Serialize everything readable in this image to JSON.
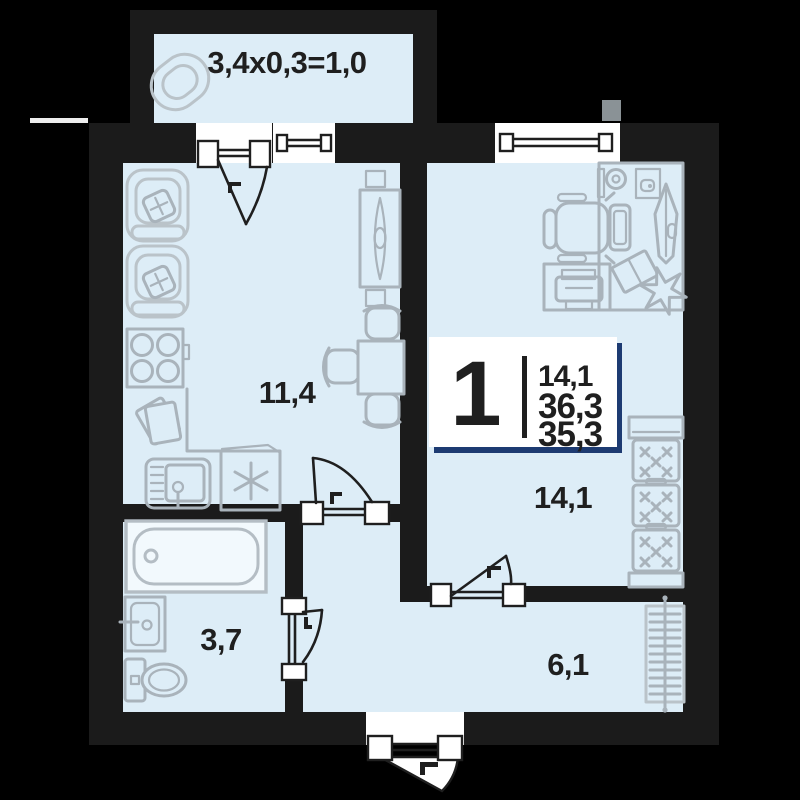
{
  "plan": {
    "balcony_label": "3,4x0,3=1,0",
    "rooms": {
      "kitchen_living": "11,4",
      "bedroom": "14,1",
      "bathroom": "3,7",
      "hallway": "6,1"
    },
    "badge": {
      "rooms_count": "1",
      "values": [
        "14,1",
        "36,3",
        "35,3"
      ]
    },
    "colors": {
      "background": "#000000",
      "wall": "#1b1b1b",
      "room_fill": "#ddedf7",
      "furniture": "#a9b3bb",
      "accent_navy": "#1d3b72",
      "text": "#1f1f1f",
      "white": "#ffffff"
    },
    "icons": [
      "papasan-chair-icon",
      "armchair-icon",
      "stove-icon",
      "papers-icon",
      "kitchen-sink-icon",
      "fridge-freezer-icon",
      "tv-stand-icon",
      "dining-table-icon",
      "chair-icon",
      "office-chair-icon",
      "desk-icon",
      "monitor-icon",
      "cup-icon",
      "picture-frame-icon",
      "mirror-board-icon",
      "plant-icon",
      "printer-icon",
      "wardrobe-icon",
      "radiator-icon",
      "bathtub-icon",
      "washbasin-icon",
      "toilet-icon",
      "door-icon",
      "window-icon"
    ]
  }
}
